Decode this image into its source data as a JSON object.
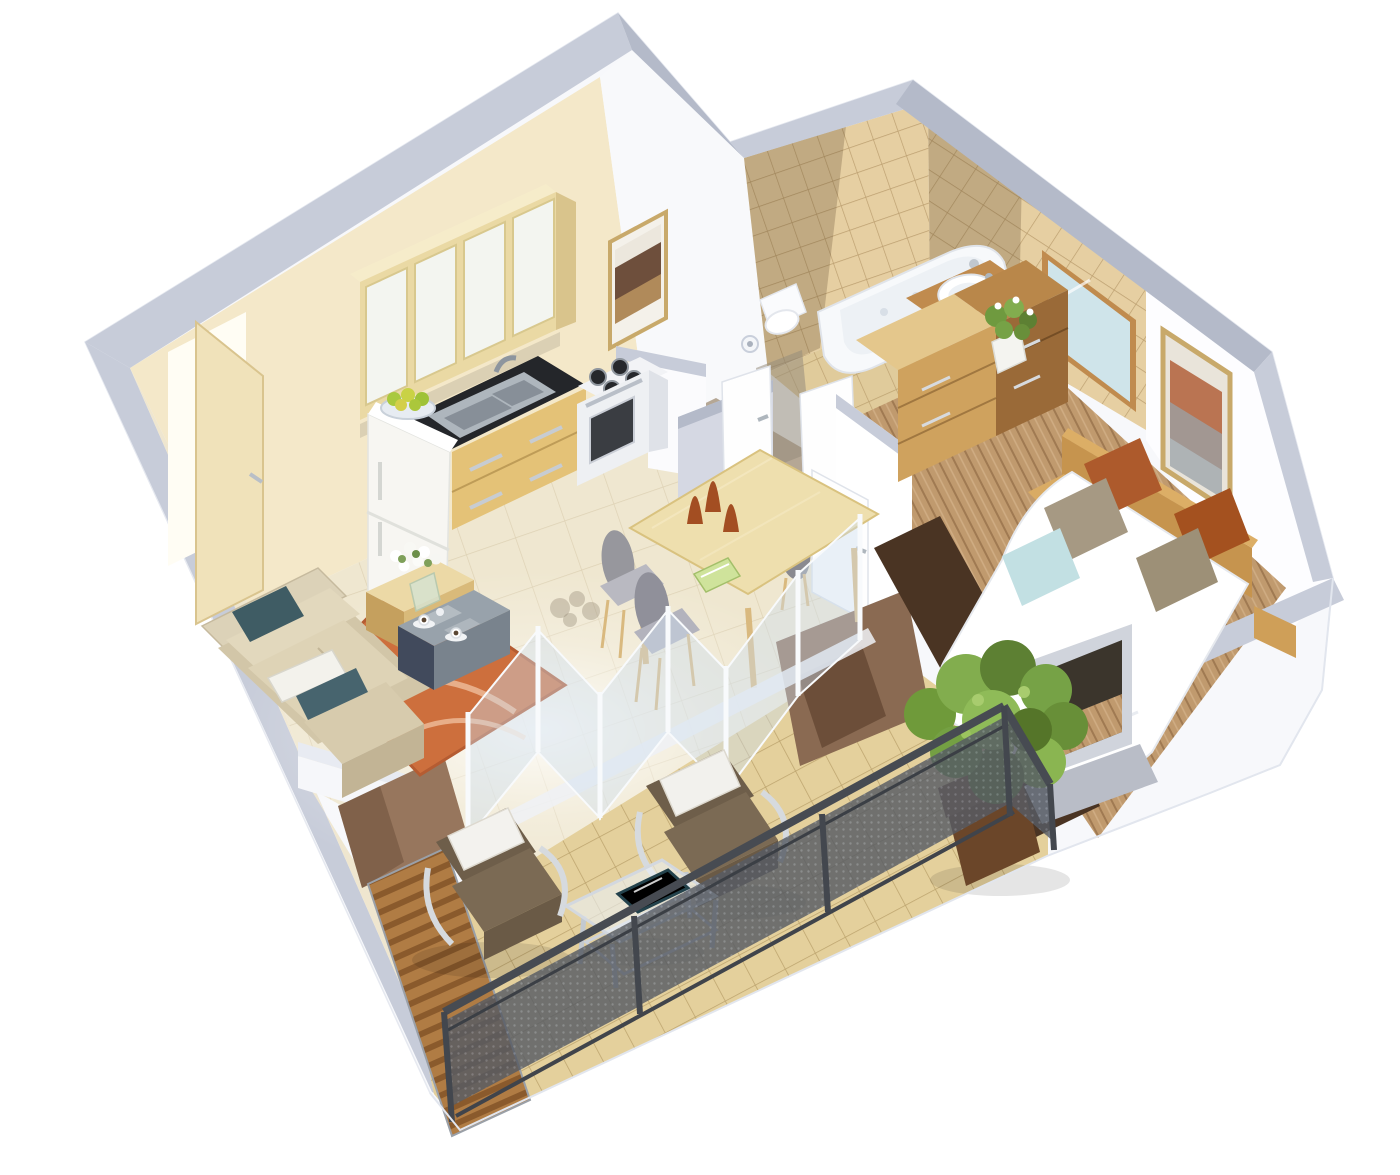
{
  "title": "3D isometric cutaway floor plan — one-bedroom apartment with terrace",
  "palette": {
    "ext_white": "#f7f8fb",
    "wall_top": "#c7ccd9",
    "wall_top_dark": "#b4bac9",
    "wall_white": "#fdfdff",
    "wall_cream": "#f4e8c9",
    "hall_wall": "#f8f9fb",
    "hall_wall_shade": "#d5d8e3",
    "floor_cream": "#efe7d0",
    "hall_floor": "#b5a795",
    "tile_wall": "#e6cfa2",
    "tile_floor": "#e0cb9b",
    "tile_shadow": "rgba(96,76,48,0.28)",
    "wood_cab_light": "#ead9a4",
    "wood_cab_mid": "#e4c277",
    "counter_black": "#24262a",
    "steel": "#aeb6bd",
    "fridge_white": "#f7f6f2",
    "appliance_white": "#eef0f3",
    "oven_dark": "#3a3d42",
    "table_wood": "#eedfae",
    "chair_gray": "#92929a",
    "chair_leg": "#d9b97f",
    "vase_rust": "#a34e22",
    "book_green": "#cfe39b",
    "rug_orange": "#cd6f3d",
    "rug_arc": "rgba(255,225,200,0.55)",
    "sofa_base": "#d2c6a8",
    "sofa_light": "#dcd2b8",
    "sofa_cushion": "#ded3b6",
    "sofa_dark": "#c2b495",
    "pillow_teal": "#3f5c64",
    "pillow_white": "#f3f2ec",
    "stone_top": "#98a2ab",
    "stone_side": "#79838d",
    "stone_dark": "#414a5c",
    "coffee_wood": "#ecd9a6",
    "bed_white": "#ffffff",
    "headboard_wood": "#c6944e",
    "pillow_rust": "#ad5a2c",
    "pillow_taupe": "#a69983",
    "pillow_blue": "#c2e0e3",
    "bedroom_floor": "#c09a6e",
    "bedroom_rug": "#4a3423",
    "dresser_light": "#cfa25e",
    "dresser_dark": "#9a6a38",
    "dresser_top": "#e4c78c",
    "mirror_blue": "#cfe4ea",
    "bath_white": "#f7f9fb",
    "vanity_wood": "#c08b4e",
    "deck_tan": "#e4d09c",
    "railing": "#474b52",
    "mesh": "#565b64",
    "mesh_dot": "#777d88",
    "slat_light": "#b07c44",
    "slat_dark": "#8a5a2c",
    "accent_brown": "#8a6a52",
    "accent_brown_light": "#97765d",
    "pot_brown": "#6b4629",
    "plant_green": "#76a246",
    "plant_green_dark": "#5d8033",
    "glass_blue": "rgba(205,222,238,0.42)",
    "glass_frame": "#f8fafc",
    "frame_gold": "#c8a96a",
    "art_brown": "#6e4f3c",
    "art_rust": "#b2603a",
    "art_gray": "#9aa3a8",
    "door_beige": "#f0e2ba",
    "door_white": "#fefefe",
    "glow": "#fffdf4"
  },
  "scene": {
    "type": "isometric-cutaway-floor-plan",
    "rooms": [
      {
        "name": "kitchen",
        "items": [
          "upper cabinets with frosted doors",
          "double stainless sink with faucet",
          "black countertop",
          "wood drawer cabinet",
          "white fridge with fruit bowl",
          "stove with 4 burners and oven"
        ]
      },
      {
        "name": "dining area",
        "items": [
          "light wood dining table",
          "4 gray oval-back chairs",
          "3 rust decorative vases",
          "green book"
        ]
      },
      {
        "name": "living room",
        "items": [
          "L-shaped beige sofa",
          "teal and white pillows",
          "orange patterned rug",
          "wood coffee table",
          "white flower vase",
          "gray stone side table with two coffee cups"
        ]
      },
      {
        "name": "hallway",
        "items": [
          "wall sconce",
          "framed picture",
          "white interior doors"
        ]
      },
      {
        "name": "bathroom",
        "items": [
          "bathtub",
          "wood-top vanity with round basin",
          "mirror",
          "white cabinet",
          "washing machine",
          "tan wall tiles"
        ]
      },
      {
        "name": "wc",
        "items": [
          "toilet"
        ]
      },
      {
        "name": "bedroom",
        "items": [
          "double bed with white duvet",
          "wood headboard",
          "rust taupe and blue pillows",
          "dark brown rug",
          "two-tone wood dresser",
          "potted plant",
          "framed artwork",
          "window opening"
        ]
      },
      {
        "name": "terrace",
        "items": [
          "two brown armchairs with white cushions",
          "metal glass side table",
          "blue tablet",
          "potted shrub",
          "dark metal mesh railing",
          "wood slat privacy screen",
          "brown accent walls",
          "folding glass doors",
          "tan deck tiles"
        ]
      }
    ]
  }
}
